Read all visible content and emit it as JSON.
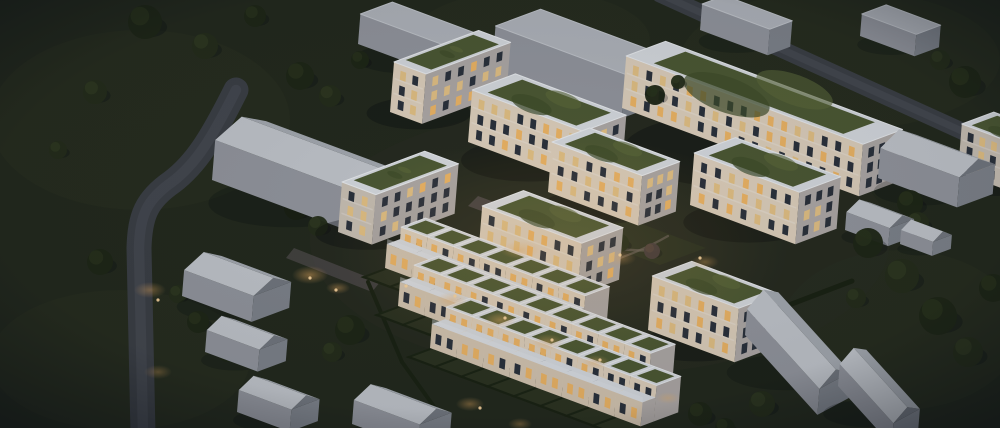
{
  "scene": {
    "width": 1000,
    "height": 428,
    "vectors": {
      "e": [
        0.94,
        0.35
      ],
      "n": [
        0.94,
        -0.35
      ],
      "up": [
        0.08,
        -1
      ]
    },
    "colors": {
      "grass": "#232a1d",
      "grass_light": "#2a3120",
      "estate_ground": "#2e2f26",
      "road": "#3c4046",
      "road_sheen": "#4d525a",
      "sidewalk": "#585d65",
      "paving": "#6d6168",
      "path": "#6a6258",
      "facade_lit": "#e3d5c0",
      "facade_lit2": "#d9cab5",
      "facade_dim": "#cec5b8",
      "facade_side": "#b2adaa",
      "parapet": "#dce0e4",
      "parapet_edge": "#eef1f4",
      "roof_green": "#4e5b33",
      "roof_green_dark": "#404e2a",
      "roof_green_light": "#5d6b3a",
      "win_dark": "#2b323c",
      "win_lit": "#f3ba67",
      "win_lit2": "#e9c687",
      "ctx_wall": "#969aa1",
      "ctx_wall_side": "#81868e",
      "ctx_gable_tri": "#757a82",
      "ctx_roof": "#b5b9bf",
      "ctx_roof_light": "#c6cad0",
      "ctx_roof_dark": "#a9aeb5",
      "garden": "#2c3320",
      "hedge": "#1a2212",
      "tree": "#1e2715",
      "tree_hi": "#28331b",
      "tree2": "#242e19",
      "tree2_hi": "#2f3a20",
      "bare": "#4a403c",
      "bare_hi": "#57493f",
      "glow": "#f0b161",
      "dot": "#ffd9a0",
      "shadow": "#05070a",
      "cast": "#141b28",
      "vignette": "#060a12"
    },
    "mottles": [
      [
        140,
        120,
        150,
        90
      ],
      [
        840,
        60,
        160,
        70
      ],
      [
        120,
        360,
        130,
        70
      ],
      [
        900,
        330,
        120,
        80
      ],
      [
        530,
        40,
        120,
        50
      ]
    ],
    "estate_underlay": [
      600,
      240,
      290,
      135
    ],
    "roads": [
      {
        "name": "west-street",
        "d": "M 236 90 C 212 138 196 164 172 182 C 146 200 140 216 139 248 L 143 434",
        "w": 25
      },
      {
        "name": "north-street",
        "d": "M 660 -6 L 1008 152",
        "w": 17
      }
    ],
    "sidewalk": {
      "name": "north-sidewalk",
      "d": "M 648 86 L 905 182",
      "w": 4.5
    },
    "gardens": [
      {
        "name": "courtyard-garden",
        "pts": [
          [
            580,
            235
          ],
          [
            660,
            265
          ],
          [
            706,
            248
          ],
          [
            626,
            218
          ]
        ],
        "fill": "garden",
        "op": 1
      },
      {
        "name": "upper-courtyard-paving",
        "pts": [
          [
            468,
            206
          ],
          [
            586,
            250
          ],
          [
            596,
            240
          ],
          [
            478,
            196
          ]
        ],
        "fill": "paving",
        "op": 0.5
      },
      {
        "name": "west-entrance-paving",
        "pts": [
          [
            286,
            258
          ],
          [
            372,
            292
          ],
          [
            380,
            282
          ],
          [
            294,
            248
          ]
        ],
        "fill": "paving",
        "op": 0.45
      }
    ],
    "paths": [
      {
        "name": "garden-path-1",
        "d": "M 592 244 Q 625 252 656 250",
        "w": 2.5
      },
      {
        "name": "garden-path-2",
        "d": "M 608 262 Q 640 252 668 236",
        "w": 2.2
      }
    ],
    "hedges": [
      [
        692,
        342,
        852,
        281,
        5
      ],
      [
        368,
        282,
        402,
        362,
        4
      ],
      [
        402,
        362,
        448,
        426,
        4
      ]
    ],
    "estate_buildings": [
      {
        "name": "block-a1",
        "o": [
          390,
          112
        ],
        "a": 34,
        "b": 90,
        "h": 50,
        "litP": 0.6,
        "litPE": 0.55
      },
      {
        "name": "block-a2",
        "o": [
          468,
          142
        ],
        "a": 118,
        "b": 46,
        "h": 52,
        "litP": 0.6
      },
      {
        "name": "block-left",
        "o": [
          338,
          232
        ],
        "a": 36,
        "b": 88,
        "h": 50,
        "tone": "facade_dim",
        "litP": 0.45,
        "litPE": 0.5
      },
      {
        "name": "block-center",
        "o": [
          478,
          258
        ],
        "a": 106,
        "b": 44,
        "h": 52,
        "litP": 0.6
      },
      {
        "name": "block-a3",
        "o": [
          548,
          192
        ],
        "a": 96,
        "b": 40,
        "h": 50,
        "litP": 0.55
      },
      {
        "name": "block-east",
        "o": [
          690,
          205
        ],
        "a": 112,
        "b": 44,
        "h": 52,
        "litP": 0.55
      },
      {
        "name": "block-south",
        "o": [
          648,
          330
        ],
        "a": 92,
        "b": 42,
        "h": 54,
        "litP": 0.55
      },
      {
        "name": "long-building",
        "o": [
          622,
          108
        ],
        "a": 252,
        "b": 42,
        "h": 52,
        "litP": 0.5,
        "litPE": 0.3
      },
      {
        "name": "edge-building",
        "o": [
          958,
          172
        ],
        "a": 70,
        "b": 34,
        "h": 48,
        "tone": "facade_dim",
        "litP": 0.5
      }
    ],
    "townhouse_params": {
      "a": 28,
      "b": 40,
      "h1": 24,
      "h2": 36,
      "split": 14,
      "garden": 26
    },
    "townhouse_rows": [
      {
        "name": "townhouse-row-1",
        "start": [
          385,
          268
        ],
        "units": 7
      },
      {
        "name": "townhouse-row-2",
        "start": [
          398,
          306
        ],
        "units": 9
      },
      {
        "name": "townhouse-row-3",
        "start": [
          430,
          348
        ],
        "units": 8
      }
    ],
    "context_buildings": [
      {
        "name": "neighbor-flat-1",
        "o": [
          358,
          44
        ],
        "a": 92,
        "b": 34,
        "h": 30,
        "roof": "flat"
      },
      {
        "name": "neighbor-flat-2",
        "o": [
          492,
          70
        ],
        "a": 138,
        "b": 48,
        "h": 44,
        "roof": "flat"
      },
      {
        "name": "neighbor-flat-3",
        "o": [
          700,
          30
        ],
        "a": 72,
        "b": 24,
        "h": 26,
        "roof": "flat"
      },
      {
        "name": "neighbor-flat-4",
        "o": [
          860,
          36
        ],
        "a": 58,
        "b": 26,
        "h": 22,
        "roof": "flat"
      },
      {
        "name": "neighbor-gable-west",
        "o": [
          212,
          180
        ],
        "a": 148,
        "b": 54,
        "h": 40,
        "gh": 14,
        "roof": "gable"
      },
      {
        "name": "neighbor-gable-west-2",
        "o": [
          182,
          296
        ],
        "a": 74,
        "b": 40,
        "h": 26,
        "gh": 11,
        "roof": "gable"
      },
      {
        "name": "neighbor-gable-west-3",
        "o": [
          205,
          352
        ],
        "a": 56,
        "b": 30,
        "h": 22,
        "gh": 9,
        "roof": "gable"
      },
      {
        "name": "neighbor-gable-west-4",
        "o": [
          237,
          412
        ],
        "a": 56,
        "b": 30,
        "h": 22,
        "gh": 9,
        "roof": "gable"
      },
      {
        "name": "neighbor-gable-south",
        "o": [
          352,
          424
        ],
        "a": 70,
        "b": 34,
        "h": 24,
        "gh": 10,
        "roof": "gable"
      },
      {
        "name": "neighbor-gable-east",
        "o": [
          878,
          178
        ],
        "a": 84,
        "b": 38,
        "h": 30,
        "gh": 12,
        "roof": "gable"
      },
      {
        "name": "garden-shed",
        "o": [
          845,
          230
        ],
        "a": 46,
        "b": 26,
        "h": 18,
        "gh": 8,
        "roof": "gable"
      },
      {
        "name": "garden-shed-2",
        "o": [
          900,
          244
        ],
        "a": 34,
        "b": 20,
        "h": 14,
        "gh": 7,
        "roof": "gable"
      },
      {
        "name": "neighbor-gable-southeast",
        "o": [
          745,
          335
        ],
        "a": 108,
        "b": 40,
        "h": 26,
        "gh": 11,
        "roof": "gable",
        "e": [
          0.67,
          0.74
        ],
        "n": [
          0.78,
          -0.42
        ]
      },
      {
        "name": "neighbor-gable-southeast-2",
        "o": [
          838,
          386
        ],
        "a": 80,
        "b": 34,
        "h": 22,
        "gh": 9,
        "roof": "gable",
        "e": [
          0.67,
          0.74
        ],
        "n": [
          0.78,
          -0.42
        ]
      }
    ],
    "trees": [
      [
        145,
        22,
        17,
        "t1"
      ],
      [
        205,
        46,
        13,
        "t2"
      ],
      [
        255,
        16,
        11,
        "t1"
      ],
      [
        95,
        92,
        12,
        "t2"
      ],
      [
        300,
        76,
        14,
        "t1"
      ],
      [
        58,
        150,
        9,
        "t2"
      ],
      [
        330,
        96,
        11,
        "t2"
      ],
      [
        360,
        60,
        9,
        "t1"
      ],
      [
        296,
        208,
        12,
        "t1"
      ],
      [
        318,
        226,
        10,
        "t2"
      ],
      [
        178,
        294,
        9,
        "t2"
      ],
      [
        198,
        322,
        11,
        "t1"
      ],
      [
        228,
        352,
        10,
        "t2"
      ],
      [
        100,
        262,
        13,
        "t1"
      ],
      [
        350,
        330,
        15,
        "t1"
      ],
      [
        332,
        352,
        10,
        "t2"
      ],
      [
        430,
        325,
        5,
        "bare"
      ],
      [
        475,
        248,
        6,
        "bare"
      ],
      [
        620,
        243,
        9,
        "t2"
      ],
      [
        652,
        251,
        8,
        "bare"
      ],
      [
        600,
        230,
        6,
        "bare"
      ],
      [
        655,
        95,
        10,
        "t1",
        210
      ],
      [
        678,
        82,
        7,
        "t2",
        211
      ],
      [
        868,
        243,
        15,
        "t1"
      ],
      [
        902,
        276,
        17,
        "t2"
      ],
      [
        938,
        316,
        19,
        "t1"
      ],
      [
        968,
        352,
        15,
        "t2"
      ],
      [
        918,
        223,
        11,
        "t2"
      ],
      [
        993,
        288,
        14,
        "t1"
      ],
      [
        856,
        298,
        10,
        "t2"
      ],
      [
        965,
        82,
        16,
        "t1"
      ],
      [
        991,
        138,
        14,
        "t2"
      ],
      [
        940,
        60,
        10,
        "t2"
      ],
      [
        910,
        203,
        13,
        "t1"
      ],
      [
        700,
        414,
        12,
        "t1"
      ],
      [
        762,
        404,
        13,
        "t2"
      ],
      [
        725,
        428,
        10,
        "t1"
      ]
    ],
    "glows": [
      [
        560,
        250,
        230,
        115,
        0.14
      ],
      [
        150,
        290,
        16,
        8,
        0.4
      ],
      [
        158,
        372,
        14,
        7,
        0.32
      ],
      [
        310,
        275,
        18,
        9,
        0.5
      ],
      [
        338,
        288,
        12,
        6,
        0.4
      ],
      [
        452,
        300,
        16,
        8,
        0.45
      ],
      [
        500,
        320,
        16,
        8,
        0.45
      ],
      [
        548,
        342,
        16,
        8,
        0.4
      ],
      [
        596,
        362,
        14,
        7,
        0.4
      ],
      [
        470,
        404,
        14,
        7,
        0.4
      ],
      [
        520,
        424,
        12,
        6,
        0.35
      ],
      [
        520,
        250,
        20,
        9,
        0.4
      ],
      [
        620,
        258,
        16,
        8,
        0.35
      ],
      [
        705,
        262,
        14,
        7,
        0.35
      ],
      [
        668,
        398,
        12,
        6,
        0.35
      ]
    ],
    "light_dots": [
      [
        455,
        296
      ],
      [
        505,
        318
      ],
      [
        552,
        340
      ],
      [
        600,
        360
      ],
      [
        480,
        408
      ],
      [
        406,
        286
      ],
      [
        620,
        255
      ],
      [
        700,
        258
      ],
      [
        158,
        300
      ],
      [
        310,
        278
      ],
      [
        336,
        290
      ]
    ]
  }
}
